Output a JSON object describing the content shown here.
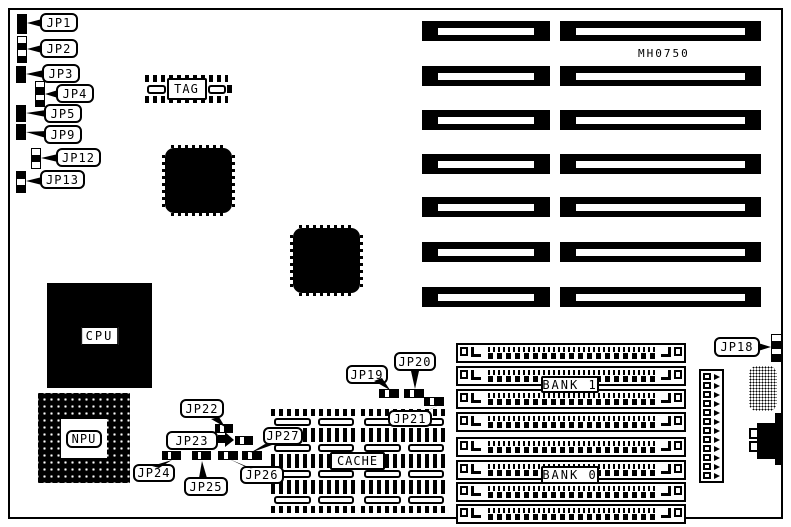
{
  "board": {
    "model_label": "MH0750"
  },
  "chips": {
    "cpu_label": "CPU",
    "npu_label": "NPU",
    "tag_label": "TAG",
    "cache_label": "CACHE"
  },
  "memory": {
    "bank1_label": "BANK 1",
    "bank0_label": "BANK 0",
    "sockets_per_bank": 4
  },
  "expansion": {
    "slot_pairs": 7
  },
  "jumper_labels": {
    "jp1": "JP1",
    "jp2": "JP2",
    "jp3": "JP3",
    "jp4": "JP4",
    "jp5": "JP5",
    "jp9": "JP9",
    "jp12": "JP12",
    "jp13": "JP13",
    "jp18": "JP18",
    "jp19": "JP19",
    "jp20": "JP20",
    "jp21": "JP21",
    "jp22": "JP22",
    "jp23": "JP23",
    "jp24": "JP24",
    "jp25": "JP25",
    "jp26": "JP26",
    "jp27": "JP27"
  }
}
